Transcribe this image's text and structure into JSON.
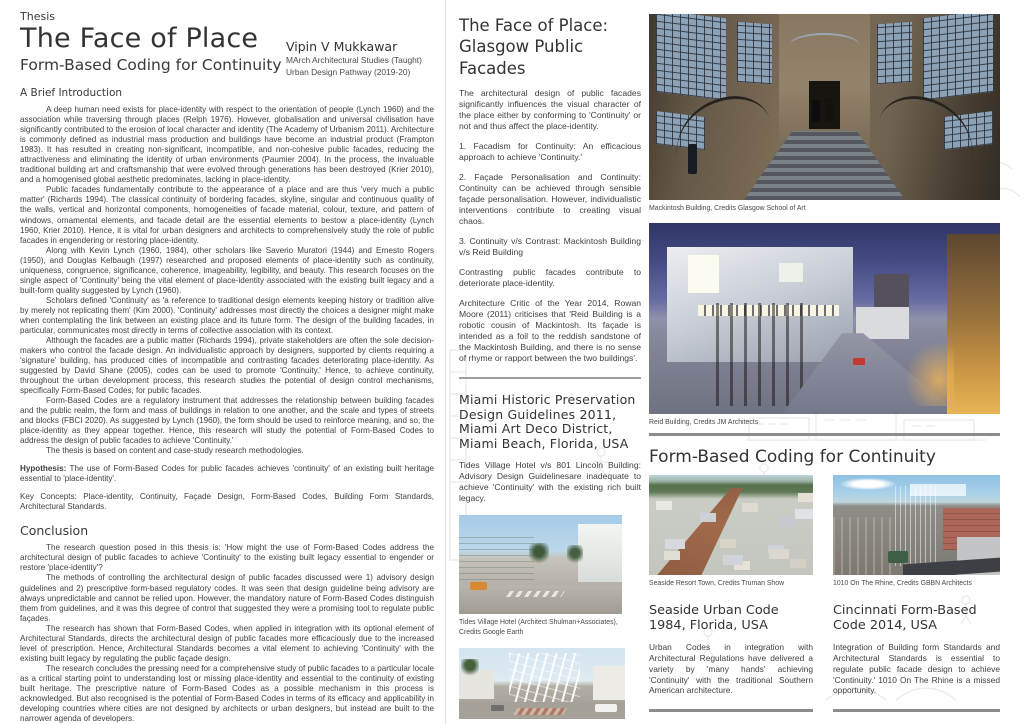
{
  "left": {
    "kicker": "Thesis",
    "title": "The Face of Place",
    "subtitle": "Form-Based Coding for Continuity",
    "author": {
      "name": "Vipin V Mukkawar",
      "line1": "MArch Architectural Studies (Taught)",
      "line2": "Urban Design Pathway (2019-20)"
    },
    "intro_heading": "A Brief Introduction",
    "intro_paras": [
      "A deep human need exists for place-identity with respect to the orientation of people (Lynch 1960) and the association while traversing through places (Relph 1976). However, globalisation and universal civilisation have significantly contributed to the erosion of local character and identity (The Academy of Urbanism 2011). Architecture is commonly defined as industrial mass production and buildings have become an industrial product (Frampton 1983). It has resulted in creating non-significant, incompatible, and non-cohesive public facades, reducing the attractiveness and eliminating the identity of urban environments (Paumier 2004). In the process, the invaluable traditional building art and craftsmanship that were evolved through generations has been destroyed (Krier 2010), and a homogenised global aesthetic predominates, lacking in place-identity.",
      "Public facades fundamentally contribute to the appearance of a place and are thus 'very much a public matter' (Richards 1994). The classical continuity of bordering facades, skyline, singular and continuous quality of the walls, vertical and horizontal components, homogeneities of facade material, colour, texture, and pattern of windows, ornamental elements, and facade detail are the essential elements to bestow a place-identity (Lynch 1960, Krier 2010). Hence, it is vital for urban designers and architects to comprehensively study the role of public facades in engendering or restoring place-identity.",
      "Along with Kevin Lynch (1960, 1984), other scholars like Saverio Muratori (1944) and Ernesto Rogers (1950), and Douglas Kelbaugh (1997) researched and proposed elements of place-identity such as continuity, uniqueness, congruence, significance, coherence, imageability, legibility, and beauty. This research focuses on the single aspect of 'Continuity' being the vital element of place-identity associated with the existing built legacy and a built-form quality suggested by Lynch (1960).",
      "Scholars defined 'Continuity' as 'a reference to traditional design elements keeping history or tradition alive by merely not replicating them' (Kim 2000). 'Continuity' addresses most directly the choices a designer might make when contemplating the link between an existing place and its future form. The design of the building facades, in particular, communicates most directly in terms of collective association with its context.",
      "Although the facades are a public matter (Richards 1994), private stakeholders are often the sole decision-makers who control the facade design. An individualistic approach by designers, supported by clients requiring a 'signature' building, has produced cities of incompatible and contrasting facades deteriorating place-identity. As suggested by David Shane (2005), codes can be used to promote 'Continuity.' Hence, to achieve continuity, throughout the urban development process, this research studies the potential of design control mechanisms, specifically Form-Based Codes, for public facades.",
      "Form-Based Codes are a regulatory instrument that addresses the relationship between building facades and the public realm, the form and mass of buildings in relation to one another, and the scale and types of streets and blocks (FBCI 2020). As suggested by Lynch (1960), the form should be used to reinforce meaning, and so, the place-identity as they appear together. Hence, this research will study the potential of Form-Based Codes to address the design of public facades to achieve 'Continuity.'",
      "The thesis is based on content and case-study research methodologies."
    ],
    "hypothesis_label": "Hypothesis:",
    "hypothesis_text": " The use of Form-Based Codes for public facades achieves 'continuity' of an existing built heritage essential to 'place-identity'.",
    "key_concepts": "Key Concepts: Place-identity, Continuity, Façade Design, Form-Based Codes, Building Form Standards, Architectural Standards.",
    "conclusion_heading": "Conclusion",
    "conclusion_paras": [
      "The research question posed in this thesis is: 'How might the use of Form-Based Codes address the architectural design of public facades to achieve 'Continuity' to the existing built legacy essential to engender or restore 'place-identity'?",
      "The methods of controlling the architectural design of public facades discussed were 1) advisory design guidelines and 2) prescriptive form-based regulatory codes. It was seen that design guideline being advisory are always unpredictable and cannot be relied upon. However, the mandatory nature of Form-Based Codes distinguish them from guidelines, and it was this degree of control that suggested they were a promising tool to regulate public façades.",
      "The research has shown that Form-Based Codes, when applied in integration with its optional element of Architectural Standards, directs the architectural design of public facades more efficaciously due to the increased level of prescription. Hence, Architectural Standards becomes a vital element to achieving 'Continuity' with the existing built legacy by regulating the public façade design.",
      "The research concludes the pressing need for a comprehensive study of public facades to a particular locale as a critical starting point to understanding lost or missing place-identity and essential to the continuity of existing built heritage. The prescriptive nature of Form-Based Codes as a possible mechanism in this process is acknowledged. But also recognised is the potential of Form-Based Codes in terms of its efficacy and applicability in developing countries where cities are not designed by architects or urban designers, but instead are built to the narrower agenda of developers.",
      "Further research might include methods of collecting and documenting existing architectural built heritage and models of urban design impact assessment with reference to the fields of urban morphology."
    ]
  },
  "right": {
    "glasgow": {
      "heading_line1": "The Face of Place:",
      "heading_line2": "Glasgow Public Facades",
      "paras": [
        "The architectural design of public facades significantly influences the visual character of the place either by conforming to 'Continuity' or not and thus affect the place-identity.",
        "1. Facadism for Continuity: An efficacious approach to achieve 'Continuity.'",
        "2. Façade Personalisation and Continuity: Continuity can be achieved through sensible façade personalisation. However, individualistic interventions contribute to creating visual chaos.",
        "3. Continuity v/s Contrast: Mackintosh Building v/s Reid Building",
        "Contrasting public facades contribute to deteriorate place-identity.",
        "Architecture Critic of the Year 2014, Rowan Moore (2011) criticises that 'Reid Building is a robotic cousin of Mackintosh. Its façade is intended as a foil to the reddish sandstone of the Mackintosh Building, and there is no sense of rhyme or rapport between the two buildings'."
      ]
    },
    "miami": {
      "heading": "Miami Historic Preservation Design Guidelines 2011, Miami Art Deco District, Miami Beach, Florida, USA",
      "para": "Tides Village Hotel v/s 801 Lincoln Building: Advisory Design Guidelinesare inadequate to achieve 'Continuity' with the existing rich built legacy.",
      "fig1_caption": "Tides Village Hotel (Architect Shulman+Associates), Credits Google Earth",
      "fig2_caption": "801 Lincoln Building (Architect Shulman+Associates), Credits Google Earth"
    },
    "figures": {
      "mackintosh_caption": "Mackintosh Building, Credits Glasgow School of Art",
      "reid_caption": "Reid Building, Credits JM Architects"
    },
    "fbc": {
      "heading": "Form-Based Coding for Continuity",
      "seaside": {
        "caption": "Seaside Resort Town, Credits Truman Show",
        "heading": "Seaside Urban Code 1984, Florida, USA",
        "para": "Urban Codes in integration with Architectural Regulations have delivered a variety by 'many hands' achieving 'Continuity' with the traditional Southern American architecture."
      },
      "cincinnati": {
        "caption": "1010 On The Rhine, Credits GBBN Architects",
        "heading": "Cincinnati Form-Based Code 2014, USA",
        "para": "Integration of Building form Standards and Architectural Standards is essential to regulate public facade design to achieve 'Continuity.' 1010 On The Rhine is a missed opportunity."
      }
    }
  }
}
